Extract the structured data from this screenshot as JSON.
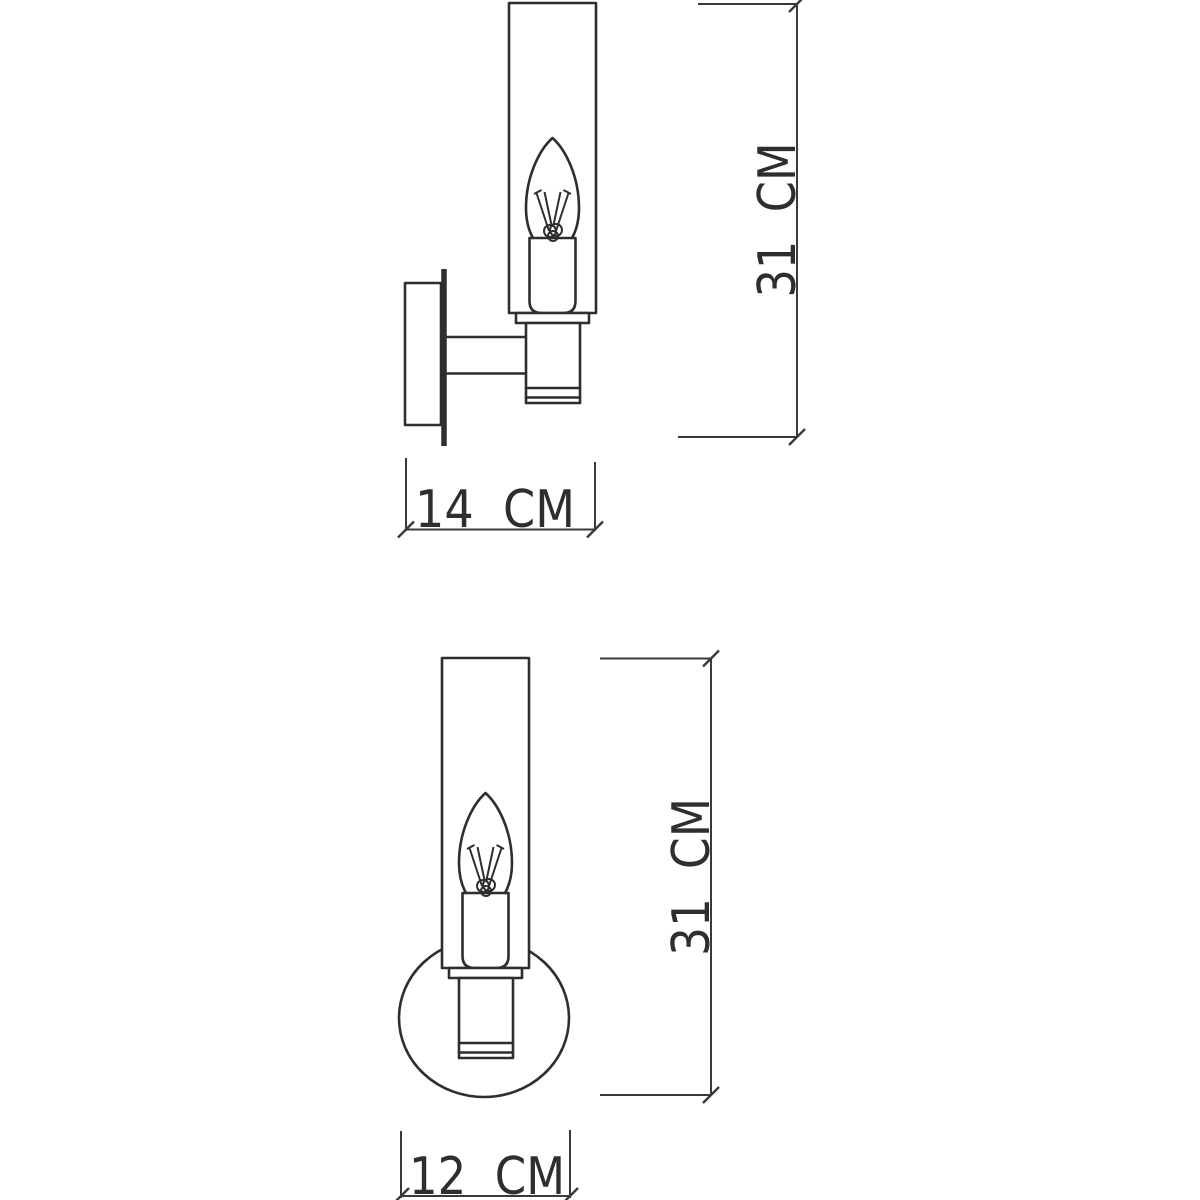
{
  "drawing": {
    "background_color": "#ffffff",
    "line_color": "#2e2e2e",
    "dimension_line_color": "#3a3a3a",
    "dimensions": {
      "side_height": "31  CM",
      "side_width": "14  CM",
      "front_height": "31  CM",
      "front_width": "12  CM"
    }
  }
}
